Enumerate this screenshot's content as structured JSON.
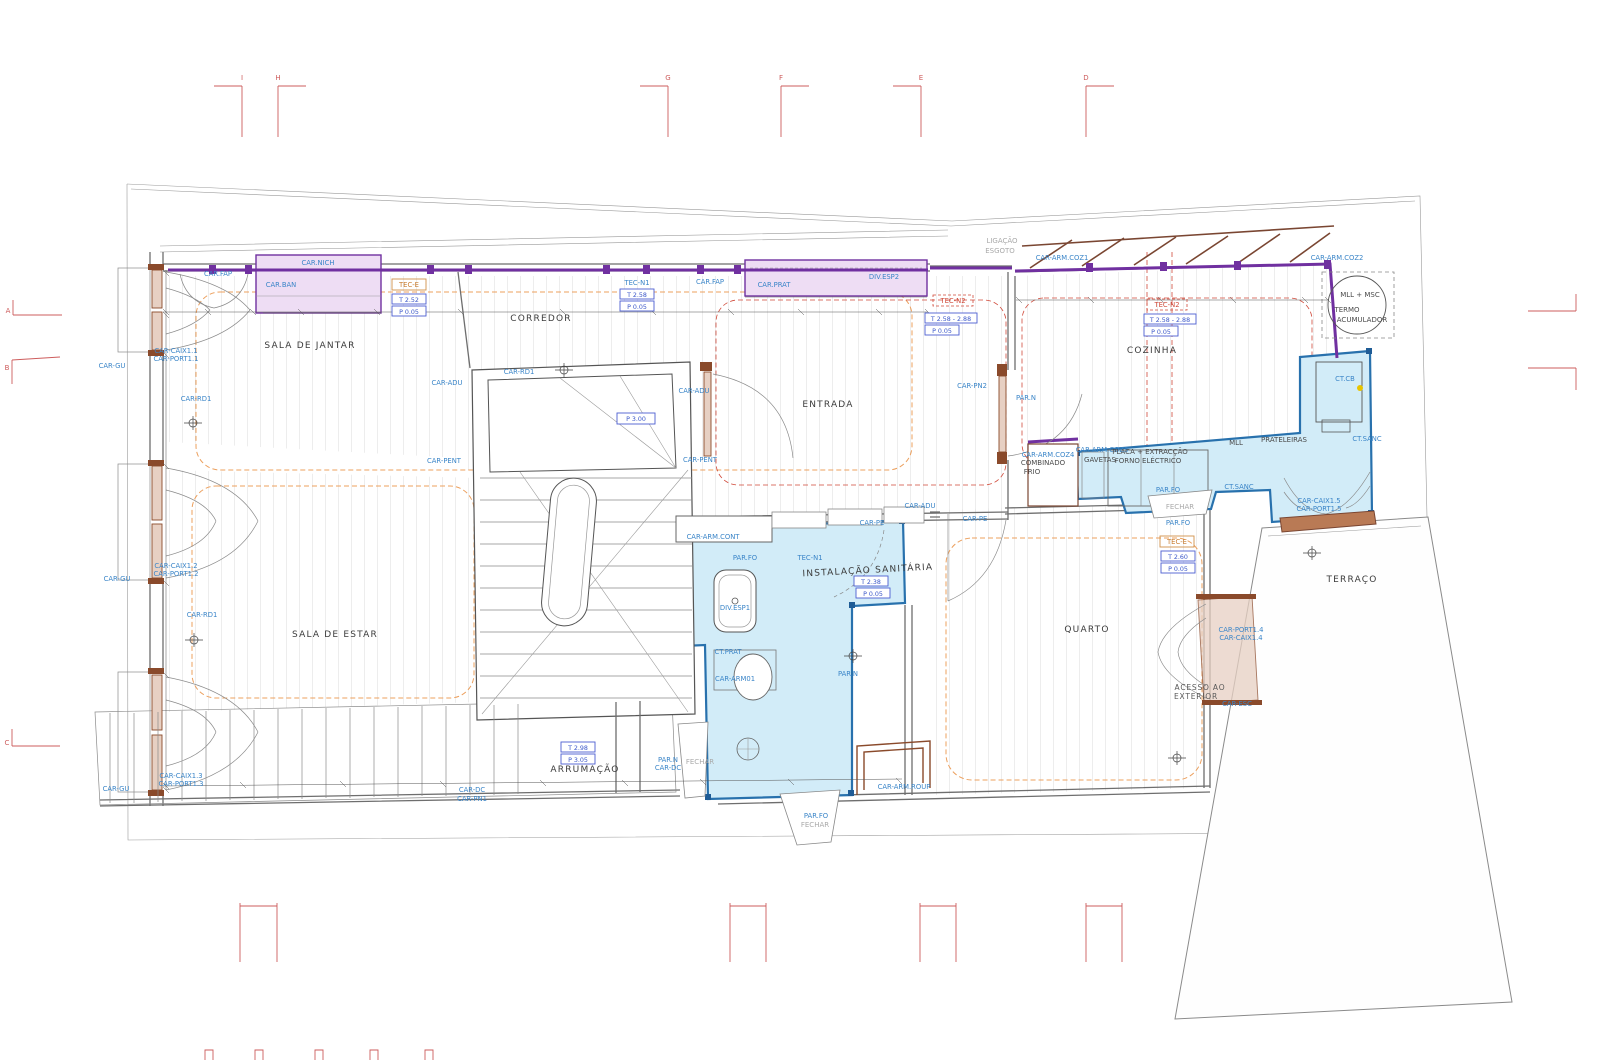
{
  "grid": {
    "top": [
      "I",
      "H",
      "G",
      "F",
      "E",
      "D"
    ],
    "left": [
      "A",
      "B",
      "C"
    ]
  },
  "rooms": {
    "sala_de_jantar": "SALA DE JANTAR",
    "corredor": "CORREDOR",
    "entrada": "ENTRADA",
    "cozinha": "COZINHA",
    "sala_de_estar": "SALA DE ESTAR",
    "arrumacao": "ARRUMAÇÃO",
    "instalacao_sanitaria": "INSTALAÇÃO SANITÁRIA",
    "quarto": "QUARTO",
    "terraco": "TERRAÇO",
    "acesso_line1": "ACESSO AO",
    "acesso_line2": "EXTERIOR"
  },
  "tags": {
    "car_fap": "CAR.FAP",
    "car_ban": "CAR.BAN",
    "car_nich": "CAR.NICH",
    "car_prat": "CAR.PRAT",
    "div_esp1": "DIV.ESP1",
    "div_esp2": "DIV.ESP2",
    "tec_e": "TEC-E",
    "tec_n1": "TEC-N1",
    "tec_n2": "TEC-N2",
    "ligacao": "LIGAÇÃO",
    "esgoto": "ESGOTO",
    "car_arm_coz1": "CAR-ARM.COZ1",
    "car_arm_coz2": "CAR-ARM.COZ2",
    "car_arm_coz3": "CAR-ARM.COZ3",
    "car_arm_coz4": "CAR-ARM.COZ4",
    "combinado": "COMBINADO",
    "frio": "FRIO",
    "gavetas": "GAVETAS",
    "placa": "PLACA + EXTRACÇÃO",
    "forno": "FORNO ELÉCTRICO",
    "mll": "MLL",
    "mll_msc": "MLL + MSC",
    "prateleiras": "PRATELEIRAS",
    "termo_1": "TERMO",
    "termo_2": "ACUMULADOR",
    "ct_sanc": "CT.SANC",
    "ct_cb": "CT.CB",
    "ct_prat": "CT.PRAT",
    "par_fo": "PAR.FO",
    "par_n": "PAR.N",
    "fechar": "FECHAR",
    "car_gu": "CAR-GU",
    "car_rd1": "CAR-RD1",
    "car_adu": "CAR-ADU",
    "car_pent": "CAR-PENT",
    "car_pe": "CAR-PE",
    "car_pn1": "CAR-PN1",
    "car_pn2": "CAR-PN2",
    "car_dc": "CAR-DC",
    "car_arm_cont": "CAR-ARM.CONT",
    "car_arm01": "CAR-ARM01",
    "car_arm_roup": "CAR-ARM.ROUP",
    "car_esc": "CAR-ESC",
    "car_caix1_1": "CAR-CAIX1.1",
    "car_port1_1": "CAR-PORT1.1",
    "car_caix1_2": "CAR-CAIX1.2",
    "car_port1_2": "CAR-PORT1.2",
    "car_caix1_3": "CAR-CAIX1.3",
    "car_port1_3": "CAR-PORT1.3",
    "car_caix1_4": "CAR-CAIX1.4",
    "car_port1_4": "CAR-PORT1.4",
    "car_caix1_5": "CAR-CAIX1.5",
    "car_port1_5": "CAR-PORT1.5"
  },
  "values": {
    "t_252": "T 2.52",
    "t_258": "T 2.58",
    "t_258_288": "T 2.58 - 2.88",
    "t_238": "T 2.38",
    "t_260": "T 2.60",
    "t_298": "T 2.98",
    "p_005": "P 0.05",
    "p_300": "P 3.00",
    "p_305": "P 3.05"
  },
  "colors": {
    "zone_purple": "#7030a0",
    "area_cyan": "#d2ecf8",
    "area_pink": "#eeddf4",
    "label_blue": "#3a85c8",
    "grid_red": "#cd5c5c",
    "door_brown": "#8a4a2b",
    "ceiling_zone_orange": "#eca05e",
    "ceiling_zone_red": "#d04a3a"
  }
}
